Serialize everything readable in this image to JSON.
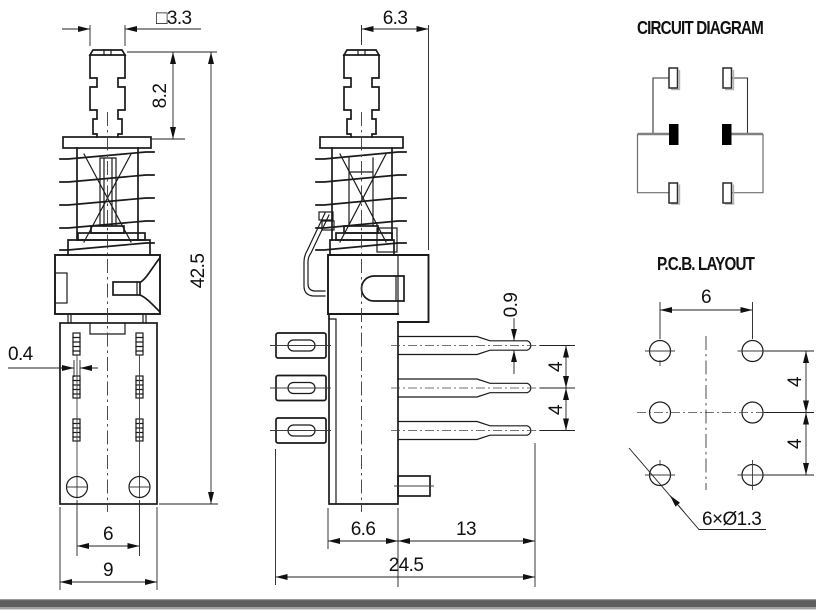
{
  "drawing": {
    "front_view": {
      "dim_square": "□3.3",
      "dim_plunger_height": "8.2",
      "dim_total_height": "42.5",
      "dim_terminal_thickness": "0.4",
      "dim_hole_spacing": "6",
      "dim_body_width": "9"
    },
    "side_view": {
      "dim_top_depth": "6.3",
      "dim_pin_tip": "0.9",
      "dim_pin_pitch_a": "4",
      "dim_pin_pitch_b": "4",
      "dim_base_depth": "6.6",
      "dim_pin_length": "13",
      "dim_total_depth": "24.5"
    },
    "circuit_diagram": {
      "title": "CIRCUIT DIAGRAM"
    },
    "pcb_layout": {
      "title": "P.C.B. LAYOUT",
      "dim_col_spacing": "6",
      "dim_row_pitch_a": "4",
      "dim_row_pitch_b": "4",
      "hole_callout": "6×Ø1.3"
    },
    "colors": {
      "line": "#1a1a1a",
      "busbar_gray": "#808080",
      "footer_bar": "#5e5e5e"
    }
  }
}
